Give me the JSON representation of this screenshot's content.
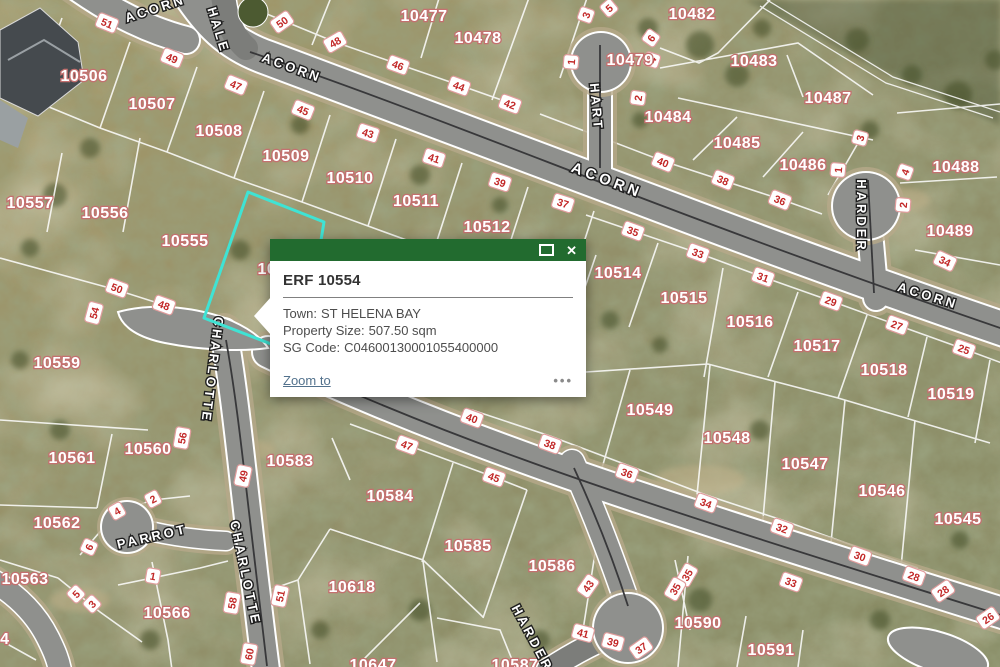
{
  "map": {
    "colors": {
      "road": "#8f908d",
      "road_shoulder": "#b7a98a",
      "boundary_line": "#ffffff",
      "parcel_label_halo": "#c4706f",
      "dimension_text": "#c22828",
      "dimension_border": "#e09c9c",
      "selected_outline": "#3fe3d4"
    },
    "parcel_labels": [
      {
        "text": "10477",
        "x": 424,
        "y": 15
      },
      {
        "text": "10478",
        "x": 478,
        "y": 37
      },
      {
        "text": "10479",
        "x": 630,
        "y": 59
      },
      {
        "text": "10482",
        "x": 692,
        "y": 13
      },
      {
        "text": "10483",
        "x": 754,
        "y": 60
      },
      {
        "text": "10484",
        "x": 668,
        "y": 116
      },
      {
        "text": "10485",
        "x": 737,
        "y": 142
      },
      {
        "text": "10486",
        "x": 803,
        "y": 164
      },
      {
        "text": "10487",
        "x": 828,
        "y": 97
      },
      {
        "text": "10488",
        "x": 956,
        "y": 166
      },
      {
        "text": "10489",
        "x": 950,
        "y": 230
      },
      {
        "text": "10506",
        "x": 84,
        "y": 75
      },
      {
        "text": "10507",
        "x": 152,
        "y": 103
      },
      {
        "text": "10508",
        "x": 219,
        "y": 130
      },
      {
        "text": "10509",
        "x": 286,
        "y": 155
      },
      {
        "text": "10510",
        "x": 350,
        "y": 177
      },
      {
        "text": "10511",
        "x": 416,
        "y": 200
      },
      {
        "text": "10512",
        "x": 487,
        "y": 226
      },
      {
        "text": "10514",
        "x": 618,
        "y": 272
      },
      {
        "text": "10515",
        "x": 684,
        "y": 297
      },
      {
        "text": "10516",
        "x": 750,
        "y": 321
      },
      {
        "text": "10517",
        "x": 817,
        "y": 345
      },
      {
        "text": "10518",
        "x": 884,
        "y": 369
      },
      {
        "text": "10519",
        "x": 951,
        "y": 393
      },
      {
        "text": "10545",
        "x": 958,
        "y": 518
      },
      {
        "text": "10546",
        "x": 882,
        "y": 490
      },
      {
        "text": "10547",
        "x": 805,
        "y": 463
      },
      {
        "text": "10548",
        "x": 727,
        "y": 437
      },
      {
        "text": "10549",
        "x": 650,
        "y": 409
      },
      {
        "text": "10554",
        "x": 281,
        "y": 268
      },
      {
        "text": "10555",
        "x": 185,
        "y": 240
      },
      {
        "text": "10556",
        "x": 105,
        "y": 212
      },
      {
        "text": "10557",
        "x": 30,
        "y": 202
      },
      {
        "text": "10559",
        "x": 57,
        "y": 362
      },
      {
        "text": "10560",
        "x": 148,
        "y": 448
      },
      {
        "text": "10561",
        "x": 72,
        "y": 457
      },
      {
        "text": "10562",
        "x": 57,
        "y": 522
      },
      {
        "text": "10563",
        "x": 25,
        "y": 578
      },
      {
        "text": "10564",
        "x": -14,
        "y": 638
      },
      {
        "text": "10566",
        "x": 167,
        "y": 612
      },
      {
        "text": "10583",
        "x": 290,
        "y": 460
      },
      {
        "text": "10584",
        "x": 390,
        "y": 495
      },
      {
        "text": "10585",
        "x": 468,
        "y": 545
      },
      {
        "text": "10586",
        "x": 552,
        "y": 565
      },
      {
        "text": "10587",
        "x": 515,
        "y": 664
      },
      {
        "text": "10590",
        "x": 698,
        "y": 622
      },
      {
        "text": "10591",
        "x": 771,
        "y": 649
      },
      {
        "text": "10618",
        "x": 352,
        "y": 586
      },
      {
        "text": "10647",
        "x": 373,
        "y": 664
      }
    ],
    "street_labels": [
      {
        "text": "ACORN",
        "x": 155,
        "y": 8,
        "rot": -18,
        "big": false
      },
      {
        "text": "ACORN",
        "x": 292,
        "y": 67,
        "rot": 20,
        "big": false
      },
      {
        "text": "ACORN",
        "x": 607,
        "y": 180,
        "rot": 21,
        "big": true
      },
      {
        "text": "ACORN",
        "x": 928,
        "y": 295,
        "rot": 17,
        "big": false
      },
      {
        "text": "HALE",
        "x": 219,
        "y": 30,
        "rot": 73,
        "big": false
      },
      {
        "text": "HART",
        "x": 597,
        "y": 107,
        "rot": 85,
        "big": false
      },
      {
        "text": "HARDER",
        "x": 862,
        "y": 216,
        "rot": 90,
        "big": false
      },
      {
        "text": "HARDER",
        "x": 533,
        "y": 638,
        "rot": 62,
        "big": false
      },
      {
        "text": "CHARLOTTE",
        "x": 213,
        "y": 370,
        "rot": 97,
        "big": false
      },
      {
        "text": "CHARLOTTE",
        "x": 246,
        "y": 573,
        "rot": 78,
        "big": false
      },
      {
        "text": "PARROT",
        "x": 152,
        "y": 536,
        "rot": -13,
        "big": false
      }
    ],
    "dimension_labels": [
      {
        "text": "51",
        "x": 107,
        "y": 23,
        "rot": 22
      },
      {
        "text": "49",
        "x": 172,
        "y": 58,
        "rot": 22
      },
      {
        "text": "47",
        "x": 236,
        "y": 85,
        "rot": 22
      },
      {
        "text": "45",
        "x": 303,
        "y": 110,
        "rot": 22
      },
      {
        "text": "50",
        "x": 282,
        "y": 22,
        "rot": -35
      },
      {
        "text": "48",
        "x": 335,
        "y": 42,
        "rot": -30
      },
      {
        "text": "46",
        "x": 398,
        "y": 65,
        "rot": 20
      },
      {
        "text": "44",
        "x": 459,
        "y": 86,
        "rot": 20
      },
      {
        "text": "42",
        "x": 510,
        "y": 104,
        "rot": 20
      },
      {
        "text": "43",
        "x": 368,
        "y": 133,
        "rot": 18
      },
      {
        "text": "41",
        "x": 434,
        "y": 158,
        "rot": 18
      },
      {
        "text": "39",
        "x": 500,
        "y": 182,
        "rot": 18
      },
      {
        "text": "37",
        "x": 563,
        "y": 203,
        "rot": 18
      },
      {
        "text": "3",
        "x": 586,
        "y": 15,
        "rot": -70
      },
      {
        "text": "5",
        "x": 609,
        "y": 8,
        "rot": -40
      },
      {
        "text": "1",
        "x": 571,
        "y": 62,
        "rot": -85
      },
      {
        "text": "6",
        "x": 651,
        "y": 38,
        "rot": -55
      },
      {
        "text": "4",
        "x": 652,
        "y": 60,
        "rot": -72
      },
      {
        "text": "2",
        "x": 638,
        "y": 98,
        "rot": -82
      },
      {
        "text": "40",
        "x": 663,
        "y": 162,
        "rot": 22
      },
      {
        "text": "38",
        "x": 723,
        "y": 180,
        "rot": 22
      },
      {
        "text": "36",
        "x": 780,
        "y": 200,
        "rot": 22
      },
      {
        "text": "35",
        "x": 633,
        "y": 231,
        "rot": 20
      },
      {
        "text": "33",
        "x": 698,
        "y": 253,
        "rot": 20
      },
      {
        "text": "31",
        "x": 763,
        "y": 277,
        "rot": 20
      },
      {
        "text": "29",
        "x": 831,
        "y": 301,
        "rot": 20
      },
      {
        "text": "27",
        "x": 897,
        "y": 325,
        "rot": 20
      },
      {
        "text": "25",
        "x": 964,
        "y": 349,
        "rot": 20
      },
      {
        "text": "3",
        "x": 860,
        "y": 138,
        "rot": -75
      },
      {
        "text": "1",
        "x": 838,
        "y": 170,
        "rot": -85
      },
      {
        "text": "4",
        "x": 905,
        "y": 172,
        "rot": -70
      },
      {
        "text": "2",
        "x": 903,
        "y": 205,
        "rot": -85
      },
      {
        "text": "34",
        "x": 945,
        "y": 261,
        "rot": 25
      },
      {
        "text": "50",
        "x": 117,
        "y": 288,
        "rot": 20
      },
      {
        "text": "48",
        "x": 164,
        "y": 305,
        "rot": 20
      },
      {
        "text": "54",
        "x": 94,
        "y": 313,
        "rot": -75
      },
      {
        "text": "56",
        "x": 182,
        "y": 438,
        "rot": -80
      },
      {
        "text": "49",
        "x": 243,
        "y": 476,
        "rot": -78
      },
      {
        "text": "2",
        "x": 153,
        "y": 499,
        "rot": -28
      },
      {
        "text": "4",
        "x": 117,
        "y": 511,
        "rot": -30
      },
      {
        "text": "6",
        "x": 89,
        "y": 547,
        "rot": -65
      },
      {
        "text": "5",
        "x": 76,
        "y": 594,
        "rot": -45
      },
      {
        "text": "3",
        "x": 92,
        "y": 604,
        "rot": -45
      },
      {
        "text": "1",
        "x": 153,
        "y": 576,
        "rot": 10
      },
      {
        "text": "58",
        "x": 232,
        "y": 603,
        "rot": -80
      },
      {
        "text": "51",
        "x": 280,
        "y": 596,
        "rot": -78
      },
      {
        "text": "60",
        "x": 249,
        "y": 654,
        "rot": -80
      },
      {
        "text": "40",
        "x": 472,
        "y": 418,
        "rot": 20
      },
      {
        "text": "38",
        "x": 550,
        "y": 444,
        "rot": 20
      },
      {
        "text": "36",
        "x": 627,
        "y": 473,
        "rot": 20
      },
      {
        "text": "47",
        "x": 407,
        "y": 445,
        "rot": 20
      },
      {
        "text": "45",
        "x": 494,
        "y": 477,
        "rot": 20
      },
      {
        "text": "34",
        "x": 706,
        "y": 503,
        "rot": 20
      },
      {
        "text": "32",
        "x": 782,
        "y": 528,
        "rot": 20
      },
      {
        "text": "30",
        "x": 860,
        "y": 556,
        "rot": 20
      },
      {
        "text": "28",
        "x": 914,
        "y": 576,
        "rot": 20
      },
      {
        "text": "28",
        "x": 943,
        "y": 591,
        "rot": -35
      },
      {
        "text": "26",
        "x": 988,
        "y": 618,
        "rot": -35
      },
      {
        "text": "35",
        "x": 687,
        "y": 575,
        "rot": -60
      },
      {
        "text": "35",
        "x": 675,
        "y": 589,
        "rot": -60
      },
      {
        "text": "33",
        "x": 791,
        "y": 582,
        "rot": 20
      },
      {
        "text": "43",
        "x": 588,
        "y": 586,
        "rot": -55
      },
      {
        "text": "41",
        "x": 583,
        "y": 633,
        "rot": 15
      },
      {
        "text": "39",
        "x": 613,
        "y": 642,
        "rot": 15
      },
      {
        "text": "37",
        "x": 641,
        "y": 648,
        "rot": -35
      }
    ],
    "selected_parcel": {
      "id": "10554",
      "color": "#3fe3d4",
      "outline": [
        [
          248,
          192
        ],
        [
          324,
          222
        ],
        [
          302,
          356
        ],
        [
          204,
          318
        ]
      ]
    }
  },
  "popup": {
    "title": "ERF 10554",
    "fields": [
      {
        "label": "Town:",
        "value": "ST HELENA BAY"
      },
      {
        "label": "Property Size:",
        "value": "507.50 sqm"
      },
      {
        "label": "SG Code:",
        "value": "C04600130001055400000"
      }
    ],
    "zoom_to": "Zoom to",
    "more": "•••",
    "close_glyph": "✕",
    "header_color": "#226b2f"
  }
}
